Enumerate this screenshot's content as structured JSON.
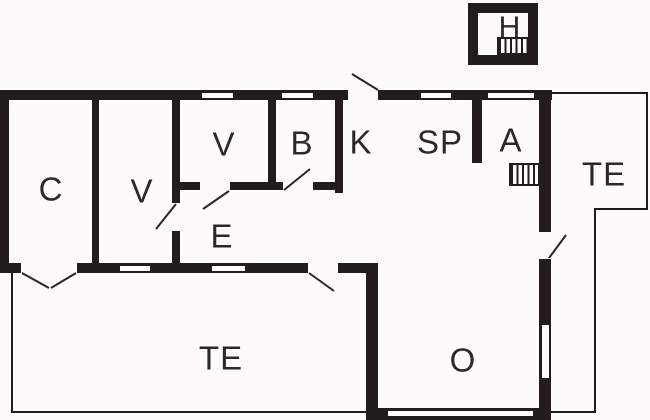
{
  "plan": {
    "title": "cottage-floor-plan",
    "rooms": [
      {
        "id": "c",
        "label": "C"
      },
      {
        "id": "v_large",
        "label": "V"
      },
      {
        "id": "v_small",
        "label": "V"
      },
      {
        "id": "b",
        "label": "B"
      },
      {
        "id": "k",
        "label": "K"
      },
      {
        "id": "sp",
        "label": "SP"
      },
      {
        "id": "a",
        "label": "A"
      },
      {
        "id": "te_right",
        "label": "TE"
      },
      {
        "id": "e",
        "label": "E"
      },
      {
        "id": "te_bottom",
        "label": "TE"
      },
      {
        "id": "o",
        "label": "O"
      },
      {
        "id": "h",
        "label": "H"
      }
    ],
    "features": {
      "stairs_count": 2,
      "door_swings": 8,
      "window_slots": 8
    },
    "colors": {
      "wall": "#221d1c",
      "background": "#fcfbf7",
      "label": "#2b2826"
    }
  }
}
